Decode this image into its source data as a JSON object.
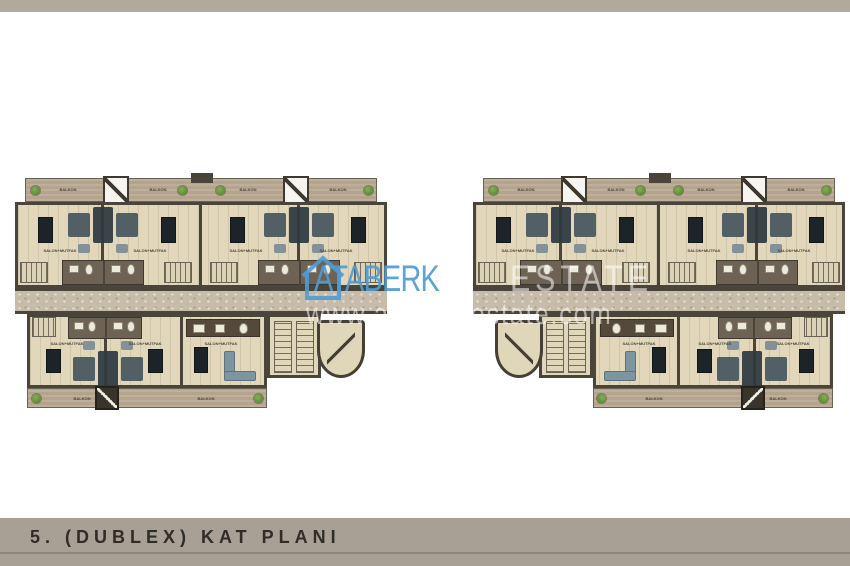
{
  "caption": "5. (DUBLEX) KAT PLANI",
  "watermark": {
    "brand": "ATABERK",
    "brand_ghost": "ESTATE",
    "url": "www.ataberkestate.com",
    "brand_color": "#4f9cd4"
  },
  "plan_labels": {
    "balcony": "BALKON",
    "living_kitchen": "SALON+MUTFAK"
  },
  "plans": [
    {
      "name": "left duplex floor plan"
    },
    {
      "name": "right duplex floor plan (mirrored lower wing)"
    }
  ],
  "colors": {
    "frame_strip": "#b2a99d",
    "caption_bar": "#a8a094",
    "caption_text": "#2f2d28",
    "floor": "#e2d7ba",
    "balcony": "#b4a48e",
    "corridor": "#c6bca9",
    "wall": "#4a443a",
    "bathroom": "#6e6254",
    "furniture_dark": "#2e3a41",
    "furniture_light": "#7d95a0",
    "plant": "#4e7a2e"
  }
}
